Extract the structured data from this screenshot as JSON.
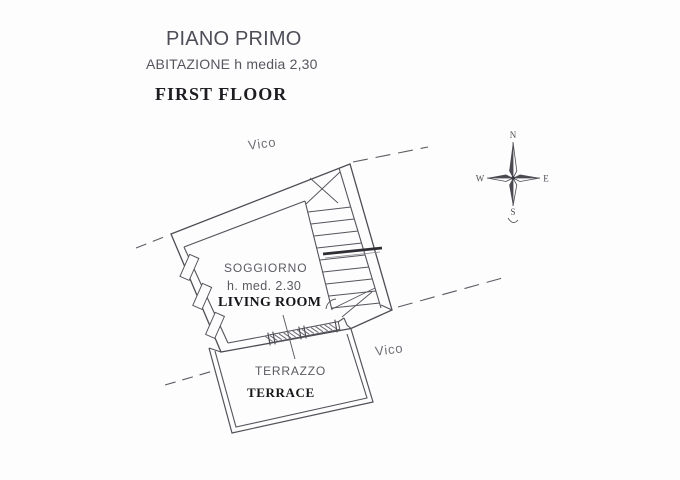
{
  "header": {
    "title": "PIANO PRIMO",
    "subtitle": "ABITAZIONE h media 2,30",
    "title_en": "FIRST FLOOR"
  },
  "plan": {
    "street_label_top": "Vico",
    "street_label_right": "Vico",
    "living_room": {
      "name_it": "SOGGIORNO",
      "height_note": "h. med. 2.30",
      "name_en": "LIVING ROOM"
    },
    "terrace": {
      "name_it": "TERRAZZO",
      "name_en": "TERRACE"
    }
  },
  "compass": {
    "north": "N",
    "east": "E",
    "south": "S",
    "west": "W"
  },
  "colors": {
    "background": "#fdfdfd",
    "ink": "#53535b",
    "ink_dark": "#2e2e34",
    "text_gray": "#56565f",
    "text_black": "#1c1c21"
  }
}
